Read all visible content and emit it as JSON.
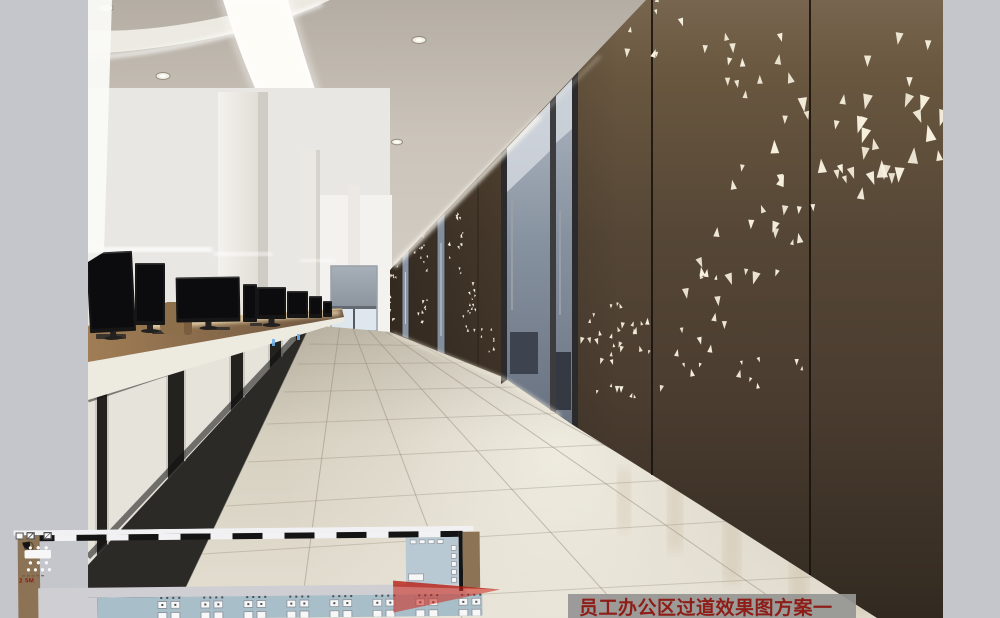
{
  "caption": {
    "text": "员工办公区过道效果图方案一",
    "text_color": "#8e1d18",
    "bg_color": "rgba(150,150,147,0.93)"
  },
  "floor_plan": {
    "scale_label": "2 5M",
    "room_count": 6,
    "open_desk_cluster_count": 8,
    "colors": {
      "bg": "#d3d2d6",
      "room": "#6a6a71",
      "wall": "#141414",
      "corridor": "#cfced3",
      "open_area": "#a8bec9",
      "side_strip": "#8c7355",
      "furniture": "#f7f7f7",
      "arrow": "#cd2418",
      "label": "#8a1612",
      "blue_room": "#b9c9d3",
      "tree": "#5a4733"
    }
  },
  "scene": {
    "border_color": "#c5c6cc",
    "palette": {
      "ceiling_dark": "#b4ada3",
      "ceiling_light": "#d9d3c9",
      "led_band": "#fdfcf7",
      "wall_top": "#77654f",
      "wall_upper": "#69573f",
      "wall_mid": "#4a3c2f",
      "wall_bottom": "#322a21",
      "triangle": "#f8f1df",
      "triangle_far": "#fff8e8",
      "floor_light": "#e4dfd2",
      "floor_mid": "#d6d0c0",
      "floor_dark": "#b5ae9e",
      "carpet": "#2b2a27",
      "wood_light": "#a07d55",
      "wood_dark": "#6e5640",
      "cabinet": "#e6e3db",
      "cabinet_gap": "#24221f",
      "monitor": "#161616",
      "glass_top": "#aeb6c1",
      "glass_bottom": "#6b7483",
      "glass_frame": "#2b2b2d",
      "blind_top": "#a7afb8",
      "blind_bottom": "#8b939d",
      "window_glass": "#dfe7ee",
      "chair": "#8d6f4c",
      "led_accent": "#6fb0e8",
      "office_bg": "#e8e7e3"
    },
    "downlights": [
      [
        105,
        8,
        8
      ],
      [
        163,
        76,
        7
      ],
      [
        200,
        121,
        6
      ],
      [
        232,
        158,
        5.5
      ],
      [
        254,
        183,
        5
      ],
      [
        271,
        205,
        4.5
      ],
      [
        284,
        224,
        4
      ],
      [
        295,
        240,
        3.5
      ],
      [
        419,
        40,
        7
      ],
      [
        397,
        142,
        5.5
      ],
      [
        382,
        190,
        4.5
      ],
      [
        373,
        238,
        4
      ],
      [
        366,
        266,
        3.5
      ]
    ],
    "monitors": [
      [
        88,
        252,
        46,
        80,
        -3
      ],
      [
        135,
        263,
        30,
        62,
        0
      ],
      [
        176,
        277,
        64,
        45,
        -1
      ],
      [
        243,
        284,
        14,
        38,
        0
      ],
      [
        257,
        287,
        29,
        32,
        0
      ],
      [
        287,
        291,
        21,
        27,
        0
      ],
      [
        309,
        296,
        13,
        22,
        0
      ],
      [
        323,
        301,
        9,
        16,
        0
      ]
    ],
    "desk_items": [
      [
        96,
        334,
        30,
        5
      ],
      [
        152,
        330,
        24,
        4
      ],
      [
        212,
        327,
        18,
        3
      ],
      [
        250,
        323,
        12,
        3
      ]
    ],
    "cabinet_gaps": [
      [
        97,
        107
      ],
      [
        168,
        184
      ],
      [
        231,
        243
      ],
      [
        270,
        281
      ],
      [
        296,
        304
      ]
    ],
    "panel_seams": [
      [
        652,
        0,
        652,
        475
      ],
      [
        810,
        0,
        810,
        575
      ]
    ],
    "panel_joints": [
      [
        478,
        177,
        478,
        367
      ]
    ],
    "radial_joints": [
      [
        300,
        618
      ],
      [
        462,
        618
      ],
      [
        628,
        618
      ],
      [
        800,
        618
      ],
      [
        920,
        618
      ],
      [
        943,
        570
      ]
    ],
    "transverse_joints": [
      [
        178,
        610,
        905,
        572
      ],
      [
        202,
        554,
        830,
        515
      ],
      [
        226,
        506,
        756,
        475
      ],
      [
        248,
        462,
        700,
        440
      ],
      [
        267,
        424,
        648,
        410
      ],
      [
        284,
        392,
        606,
        385
      ],
      [
        298,
        364,
        566,
        362
      ],
      [
        309,
        344,
        538,
        347
      ]
    ],
    "warm_reflections": [
      [
        618,
        470,
        12,
        60
      ],
      [
        668,
        480,
        14,
        70
      ],
      [
        724,
        505,
        16,
        78
      ],
      [
        790,
        545,
        18,
        73
      ],
      [
        852,
        585,
        20,
        33
      ]
    ],
    "triangle_clusters": [
      {
        "cx": 905,
        "cy": 95,
        "rx": 48,
        "ry": 88,
        "n": 20,
        "s1": 7,
        "s2": 15
      },
      {
        "cx": 828,
        "cy": 150,
        "rx": 55,
        "ry": 70,
        "n": 17,
        "s1": 6,
        "s2": 13
      },
      {
        "cx": 752,
        "cy": 228,
        "rx": 50,
        "ry": 62,
        "n": 15,
        "s1": 5,
        "s2": 11
      },
      {
        "cx": 700,
        "cy": 298,
        "rx": 42,
        "ry": 42,
        "n": 10,
        "s1": 4,
        "s2": 9
      },
      {
        "cx": 648,
        "cy": 28,
        "rx": 38,
        "ry": 30,
        "n": 8,
        "s1": 4,
        "s2": 8
      },
      {
        "cx": 760,
        "cy": 60,
        "rx": 60,
        "ry": 45,
        "n": 12,
        "s1": 5,
        "s2": 10
      },
      {
        "cx": 660,
        "cy": 352,
        "rx": 55,
        "ry": 26,
        "n": 11,
        "s1": 3.5,
        "s2": 7
      },
      {
        "cx": 605,
        "cy": 330,
        "rx": 28,
        "ry": 36,
        "n": 8,
        "s1": 3,
        "s2": 6
      },
      {
        "cx": 628,
        "cy": 392,
        "rx": 40,
        "ry": 16,
        "n": 7,
        "s1": 3,
        "s2": 6
      },
      {
        "cx": 770,
        "cy": 372,
        "rx": 38,
        "ry": 22,
        "n": 7,
        "s1": 3.5,
        "s2": 7
      },
      {
        "cx": 616,
        "cy": 330,
        "rx": 34,
        "ry": 26,
        "n": 12,
        "s1": 3.5,
        "s2": 6
      },
      {
        "cx": 393,
        "cy": 278,
        "rx": 5,
        "ry": 52,
        "n": 20,
        "s1": 1.5,
        "s2": 3
      },
      {
        "cx": 421,
        "cy": 272,
        "rx": 7,
        "ry": 60,
        "n": 24,
        "s1": 1.8,
        "s2": 3.4
      },
      {
        "cx": 456,
        "cy": 248,
        "rx": 8,
        "ry": 40,
        "n": 15,
        "s1": 2,
        "s2": 3.6
      },
      {
        "cx": 470,
        "cy": 318,
        "rx": 10,
        "ry": 38,
        "n": 15,
        "s1": 2,
        "s2": 3.6
      },
      {
        "cx": 488,
        "cy": 342,
        "rx": 11,
        "ry": 16,
        "n": 7,
        "s1": 2,
        "s2": 3.4
      }
    ]
  }
}
